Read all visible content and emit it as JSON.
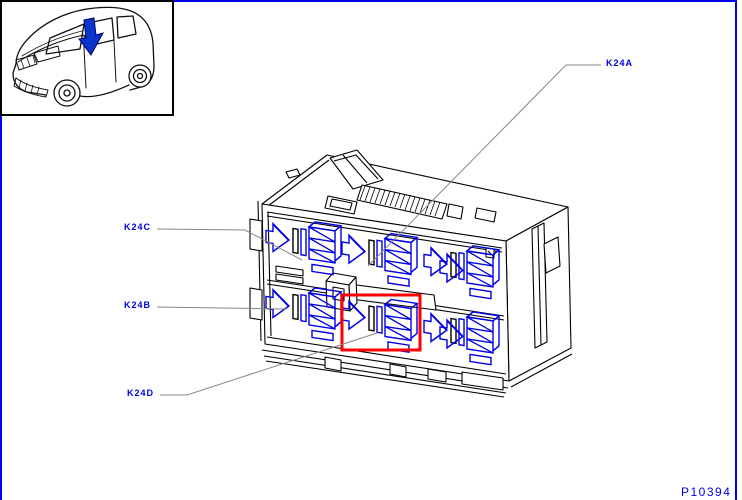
{
  "page": {
    "background": "#ffffff",
    "border_color": "#0000f0"
  },
  "vehicle_inset": {
    "description": "Line drawing of vehicle, front three-quarter view, arrow marks fuse box location at base of windshield",
    "arrow_color": "#0a35cc"
  },
  "diagram": {
    "subject": "Relay carrier / fuse box isometric line drawing",
    "part_number": "P10394",
    "callouts": [
      {
        "id": "K24A",
        "label": "K24A"
      },
      {
        "id": "K24C",
        "label": "K24C"
      },
      {
        "id": "K24B",
        "label": "K24B"
      },
      {
        "id": "K24D",
        "label": "K24D"
      }
    ],
    "colors": {
      "callout_text": "#0000e6",
      "leader_line": "#878787",
      "relay": "#0000e6",
      "outline": "#000000",
      "highlight": "#ff0000"
    }
  }
}
